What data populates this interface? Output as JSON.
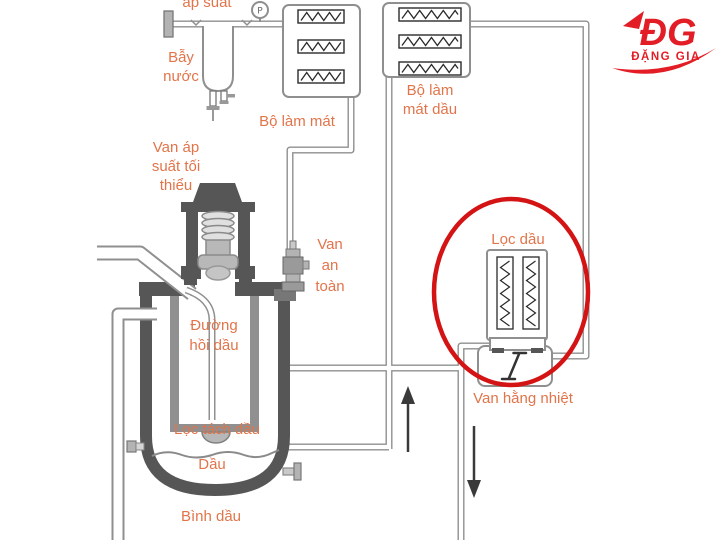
{
  "diagram_title": "Sơ đồ hệ thống dầu máy nén khí",
  "colors": {
    "label_text": "#e2744a",
    "pipe_outline": "#8f8f8f",
    "dark_metal": "#565656",
    "mid_metal": "#909090",
    "light_metal": "#b3b3b3",
    "coil": "#2a2a2a",
    "flow_arrow": "#3a3a3a",
    "highlight_ellipse": "#d41414",
    "logo_red": "#e21d25"
  },
  "labels": {
    "top_pressure": "áp suất",
    "water_trap": [
      "Bẫy",
      "nước"
    ],
    "air_cooler": "Bộ làm mát",
    "oil_cooler": [
      "Bộ làm",
      "mát dầu"
    ],
    "min_pressure_valve": [
      "Van áp",
      "suất tối",
      "thiểu"
    ],
    "safety_valve": [
      "Van",
      "an",
      "toàn"
    ],
    "oil_return_line": [
      "Đường",
      "hồi dầu"
    ],
    "oil_separator_filter": "Lọc tách dầu",
    "oil": "Dầu",
    "oil_tank": "Bình dầu",
    "oil_filter": "Lọc dầu",
    "thermostatic_valve": "Van hằng nhiệt",
    "gauge_letter": "P"
  },
  "highlight": {
    "shape": "ellipse",
    "target": "Lọc dầu",
    "color": "#d41414"
  },
  "flow_arrows": [
    "up",
    "down"
  ],
  "logo": {
    "monogram": "ĐG",
    "name": "ĐẶNG GIA",
    "color": "#e21d25"
  }
}
